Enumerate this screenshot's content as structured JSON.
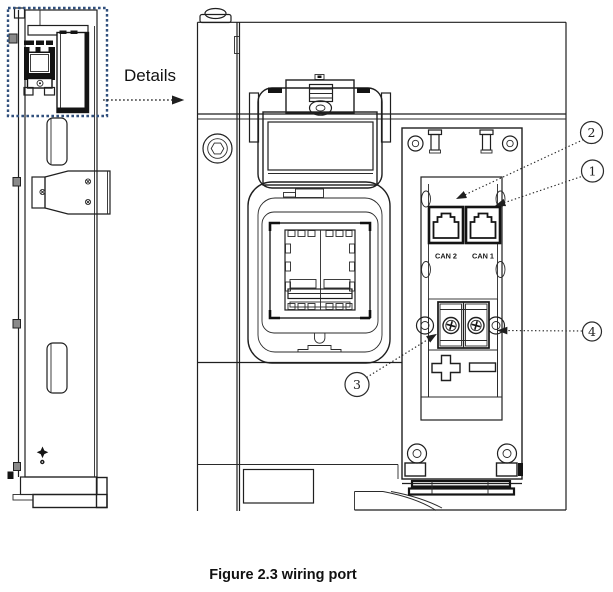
{
  "figure": {
    "caption": "Figure 2.3 wiring port",
    "details_label": "Details"
  },
  "ports": {
    "can2_label": "CAN 2",
    "can1_label": "CAN 1"
  },
  "terminal": {
    "positive_symbol": "+",
    "negative_symbol": "-"
  },
  "callouts": {
    "one": "1",
    "two": "2",
    "three": "3",
    "four": "4"
  },
  "colors": {
    "line": "#1f1f1f",
    "detail_selection_box": "#31507d"
  }
}
